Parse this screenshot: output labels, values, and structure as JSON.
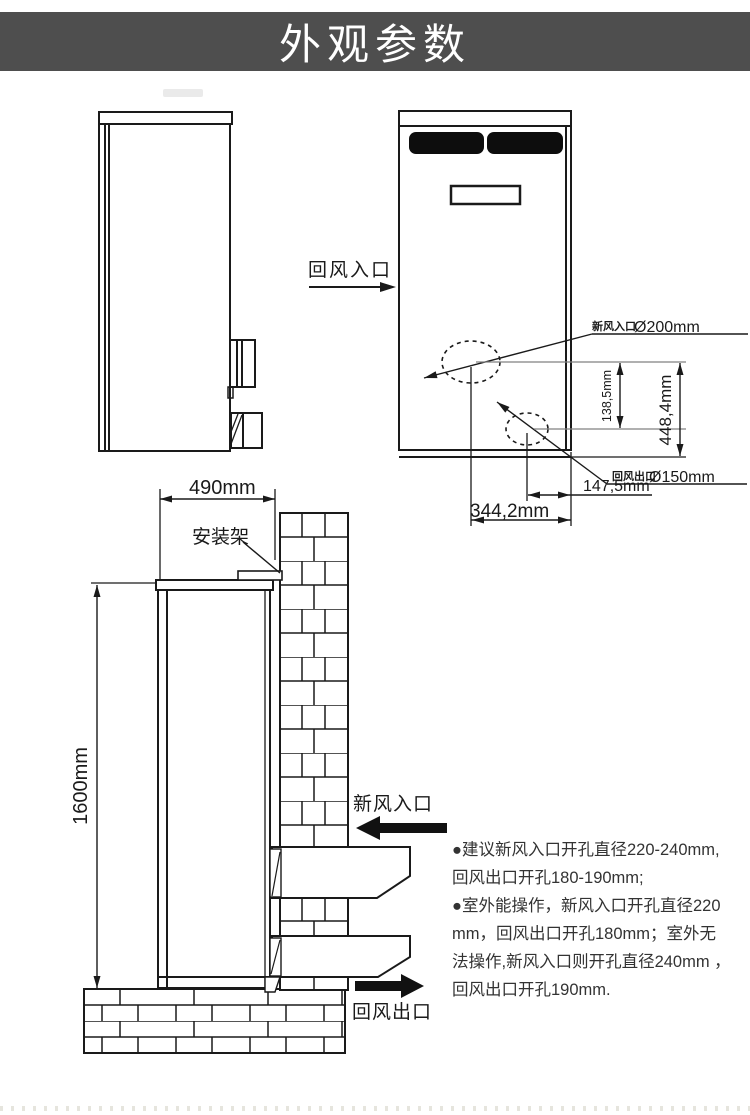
{
  "header": {
    "title": "外观参数"
  },
  "colors": {
    "header_bg": "#4e4e4e",
    "line": "#1a1a1a",
    "grille": "#0d0d0d"
  },
  "front_view": {
    "return_air_inlet_label": "回风入口",
    "fresh_air_hole": {
      "cn": "新风入口",
      "size": "Ø200mm"
    },
    "return_air_hole": {
      "cn": "回风出口",
      "size": "Ø150mm"
    },
    "dim_hole_gap": "138,5mm",
    "dim_hole_height": "448,4mm",
    "dim_hole_to_edge": "147,5mm",
    "dim_hole_span": "344,2mm"
  },
  "install_view": {
    "dim_width": "490mm",
    "dim_height": "1600mm",
    "bracket_label": "安装架",
    "fresh_air_inlet_label": "新风入口",
    "return_air_outlet_label": "回风出口"
  },
  "notes": {
    "lines": [
      "●建议新风入口开孔直径220-240mm,",
      "回风出口开孔180-190mm;",
      "●室外能操作，新风入口开孔直径220",
      "mm，回风出口开孔180mm；室外无",
      "法操作,新风入口则开孔直径240mm ，",
      "回风出口开孔190mm."
    ]
  }
}
